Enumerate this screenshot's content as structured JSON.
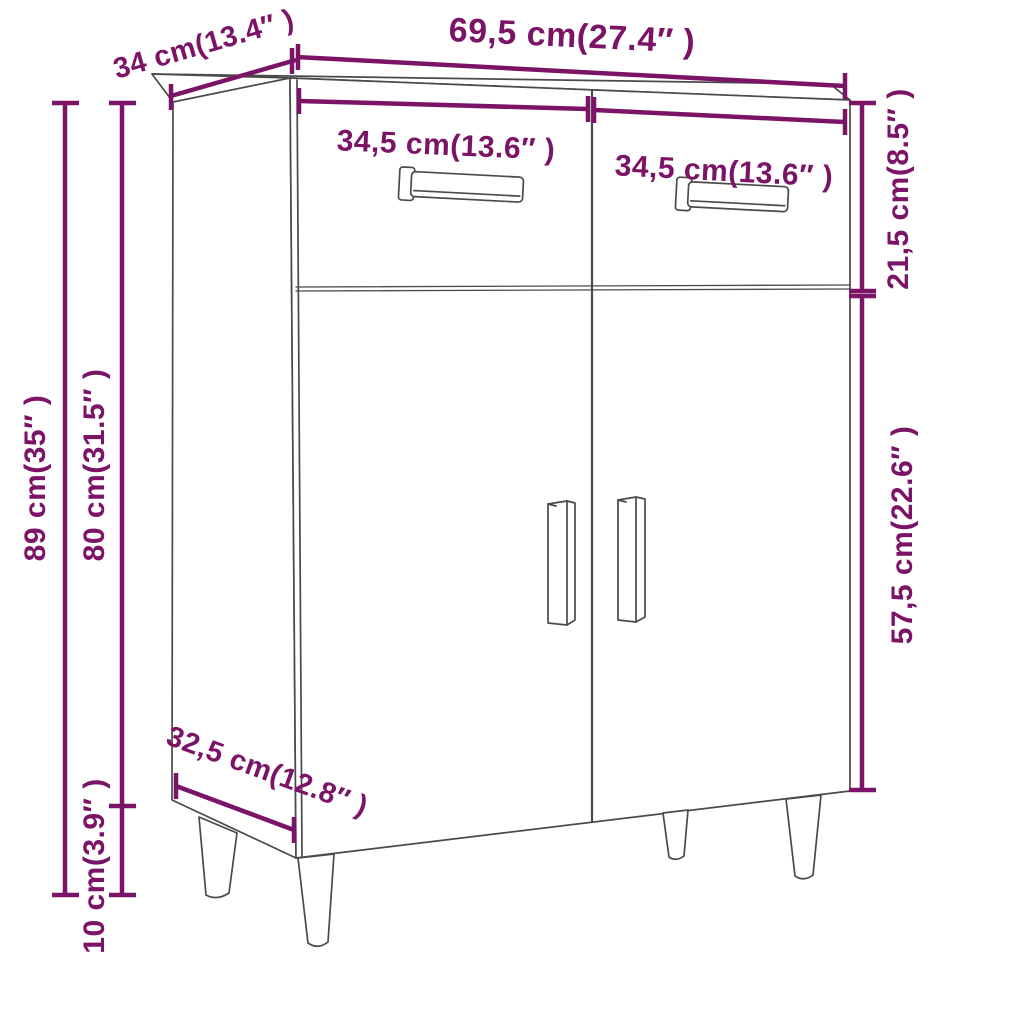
{
  "diagram": {
    "colors": {
      "accent": "#7B1366",
      "cabinet_line": "#4A4A4A",
      "background": "#FFFFFF"
    },
    "dimensions": {
      "total_width": "69,5 cm(27.4″ )",
      "top_depth": "34 cm(13.4″ )",
      "left_drawer_width": "34,5 cm(13.6″ )",
      "right_drawer_width": "34,5 cm(13.6″ )",
      "drawer_section_height": "21,5 cm(8.5″ )",
      "door_section_height": "57,5 cm(22.6″ )",
      "total_height": "89 cm(35″ )",
      "body_height": "80 cm(31.5″ )",
      "leg_height": "10 cm(3.9″ )",
      "bottom_depth": "32,5 cm(12.8″ )"
    }
  }
}
